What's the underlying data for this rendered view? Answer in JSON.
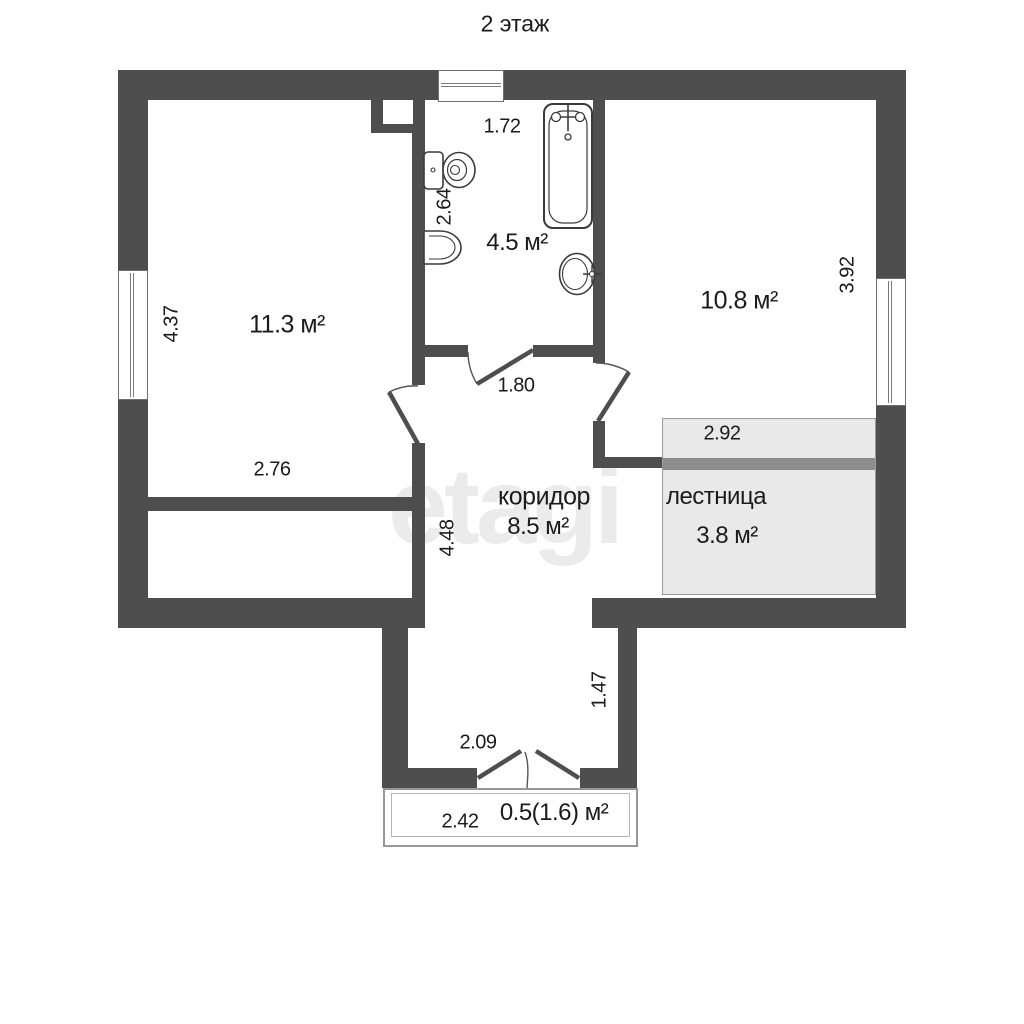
{
  "title": "2 этаж",
  "watermark": "etagi",
  "rooms": {
    "room1": {
      "area": "11.3 м²"
    },
    "bathroom": {
      "area": "4.5 м²"
    },
    "room2": {
      "area": "10.8 м²"
    },
    "corridor": {
      "name": "коридор",
      "area": "8.5 м²"
    },
    "stairs": {
      "name": "лестница",
      "area": "3.8 м²"
    },
    "balcony": {
      "area": "0.5(1.6) м²"
    }
  },
  "dimensions": {
    "bathroom_width": "1.72",
    "bathroom_depth": "2.64",
    "room1_depth": "4.37",
    "room1_width": "2.76",
    "room2_depth": "3.92",
    "corridor_door_width": "1.80",
    "corridor_depth": "4.48",
    "stairs_width": "2.92",
    "vestibule_depth": "1.47",
    "vestibule_door_width": "2.09",
    "balcony_width": "2.42"
  },
  "colors": {
    "wall": "#4e4e4e",
    "stairs_fill": "#e9e9e9",
    "stairs_band": "#8d8d8d",
    "text": "#1b1b1b",
    "watermark": "#ebebeb"
  }
}
